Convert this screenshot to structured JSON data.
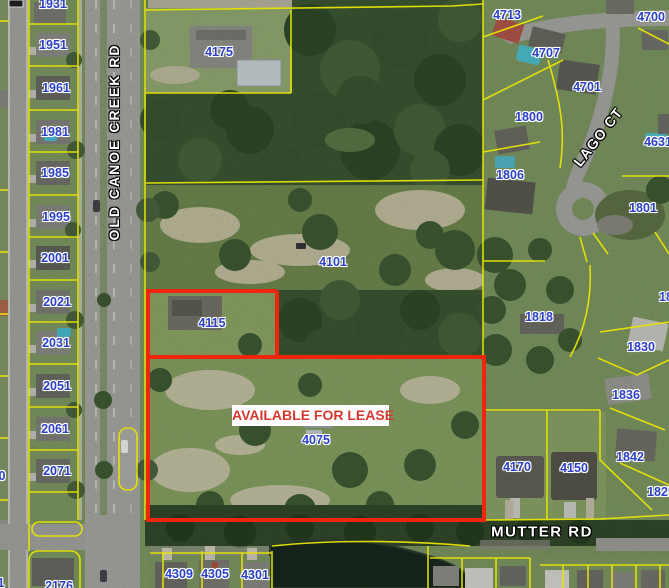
{
  "map": {
    "lease_banner": {
      "text": "AVAILABLE FOR LEASE",
      "text_color": "#d63a2e",
      "background": "#ffffff"
    },
    "boundary_colors": {
      "lease_outline": "#f0250d",
      "parcel_lines": "#e8e405"
    },
    "label_color": "#2c41c8",
    "roads": [
      {
        "name": "OLD CANOE CREEK RD"
      },
      {
        "name": "LAGO CT"
      },
      {
        "name": "MUTTER RD"
      }
    ],
    "parcel_labels": [
      {
        "text": "1931",
        "x": 53,
        "y": 4
      },
      {
        "text": "1951",
        "x": 53,
        "y": 45
      },
      {
        "text": "1961",
        "x": 56,
        "y": 88
      },
      {
        "text": "1981",
        "x": 55,
        "y": 132
      },
      {
        "text": "1985",
        "x": 55,
        "y": 173
      },
      {
        "text": "1995",
        "x": 56,
        "y": 217
      },
      {
        "text": "2001",
        "x": 55,
        "y": 258
      },
      {
        "text": "2021",
        "x": 57,
        "y": 302
      },
      {
        "text": "2031",
        "x": 56,
        "y": 343
      },
      {
        "text": "2051",
        "x": 57,
        "y": 386
      },
      {
        "text": "2061",
        "x": 55,
        "y": 429
      },
      {
        "text": "2071",
        "x": 57,
        "y": 471
      },
      {
        "text": "2176",
        "x": 59,
        "y": 586
      },
      {
        "text": "0",
        "x": 2,
        "y": 476
      },
      {
        "text": "1",
        "x": 1,
        "y": 583
      },
      {
        "text": "4175",
        "x": 219,
        "y": 52
      },
      {
        "text": "4101",
        "x": 333,
        "y": 262
      },
      {
        "text": "4115",
        "x": 212,
        "y": 323
      },
      {
        "text": "4075",
        "x": 316,
        "y": 440
      },
      {
        "text": "4713",
        "x": 507,
        "y": 15
      },
      {
        "text": "4700",
        "x": 651,
        "y": 17
      },
      {
        "text": "4707",
        "x": 546,
        "y": 53
      },
      {
        "text": "4701",
        "x": 587,
        "y": 87
      },
      {
        "text": "1800",
        "x": 529,
        "y": 117
      },
      {
        "text": "4631",
        "x": 658,
        "y": 142
      },
      {
        "text": "1806",
        "x": 510,
        "y": 175
      },
      {
        "text": "1801",
        "x": 643,
        "y": 208
      },
      {
        "text": "1818",
        "x": 539,
        "y": 317
      },
      {
        "text": "18",
        "x": 666,
        "y": 297
      },
      {
        "text": "1830",
        "x": 641,
        "y": 347
      },
      {
        "text": "1836",
        "x": 626,
        "y": 395
      },
      {
        "text": "1842",
        "x": 630,
        "y": 457
      },
      {
        "text": "4170",
        "x": 517,
        "y": 467
      },
      {
        "text": "4150",
        "x": 574,
        "y": 468
      },
      {
        "text": "1825",
        "x": 661,
        "y": 492
      },
      {
        "text": "4309",
        "x": 179,
        "y": 574
      },
      {
        "text": "4305",
        "x": 215,
        "y": 574
      },
      {
        "text": "4301",
        "x": 255,
        "y": 575
      }
    ]
  }
}
